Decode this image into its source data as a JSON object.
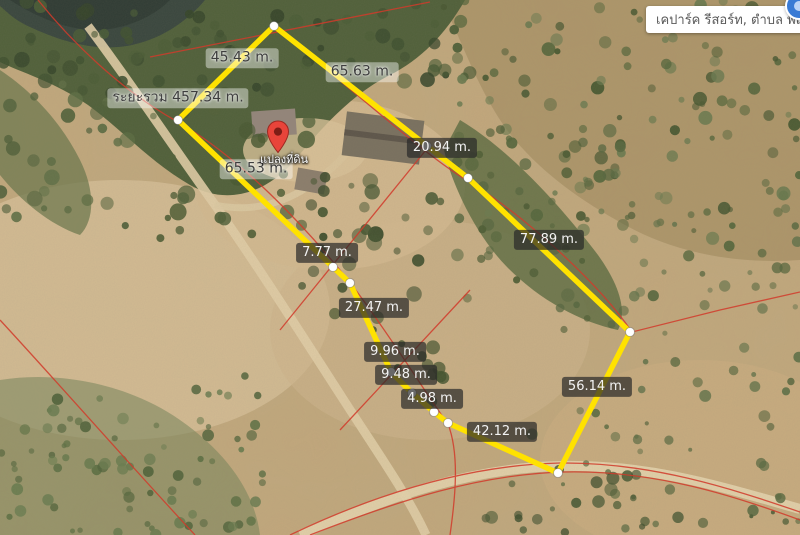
{
  "place_card": {
    "label": "เคปาร์ค รีสอร์ท, ตำบล พฤต"
  },
  "marker": {
    "label": "แปลงที่ดิน",
    "pin_color": "#e8443a"
  },
  "measurement": {
    "unit": "m.",
    "total": {
      "text": "ระยะรวม 457.34 m.",
      "x": 178,
      "y": 98
    },
    "segments": [
      {
        "text": "45.43 m.",
        "x": 242,
        "y": 58,
        "style": "light"
      },
      {
        "text": "65.63 m.",
        "x": 362,
        "y": 72,
        "style": "light"
      },
      {
        "text": "65.53 m.",
        "x": 256,
        "y": 169,
        "style": "light"
      },
      {
        "text": "20.94 m.",
        "x": 442,
        "y": 148,
        "style": "dark"
      },
      {
        "text": "77.89 m.",
        "x": 549,
        "y": 240,
        "style": "dark"
      },
      {
        "text": "7.77 m.",
        "x": 327,
        "y": 253,
        "style": "dark"
      },
      {
        "text": "27.47 m.",
        "x": 374,
        "y": 308,
        "style": "dark"
      },
      {
        "text": "9.96 m.",
        "x": 395,
        "y": 352,
        "style": "dark"
      },
      {
        "text": "9.48 m.",
        "x": 406,
        "y": 375,
        "style": "dark"
      },
      {
        "text": "4.98 m.",
        "x": 432,
        "y": 399,
        "style": "dark"
      },
      {
        "text": "42.12 m.",
        "x": 502,
        "y": 432,
        "style": "dark"
      },
      {
        "text": "56.14 m.",
        "x": 597,
        "y": 387,
        "style": "dark"
      }
    ],
    "path_px": [
      [
        178,
        120
      ],
      [
        274,
        26
      ],
      [
        427,
        146
      ],
      [
        468,
        178
      ],
      [
        630,
        332
      ],
      [
        558,
        473
      ],
      [
        448,
        423
      ],
      [
        434,
        412
      ],
      [
        412,
        393
      ],
      [
        391,
        372
      ],
      [
        350,
        283
      ],
      [
        333,
        267
      ]
    ],
    "line_color": "#ffe200",
    "vertex_color": "#ffffff"
  },
  "cadastral": {
    "line_color": "#d13b2b"
  }
}
